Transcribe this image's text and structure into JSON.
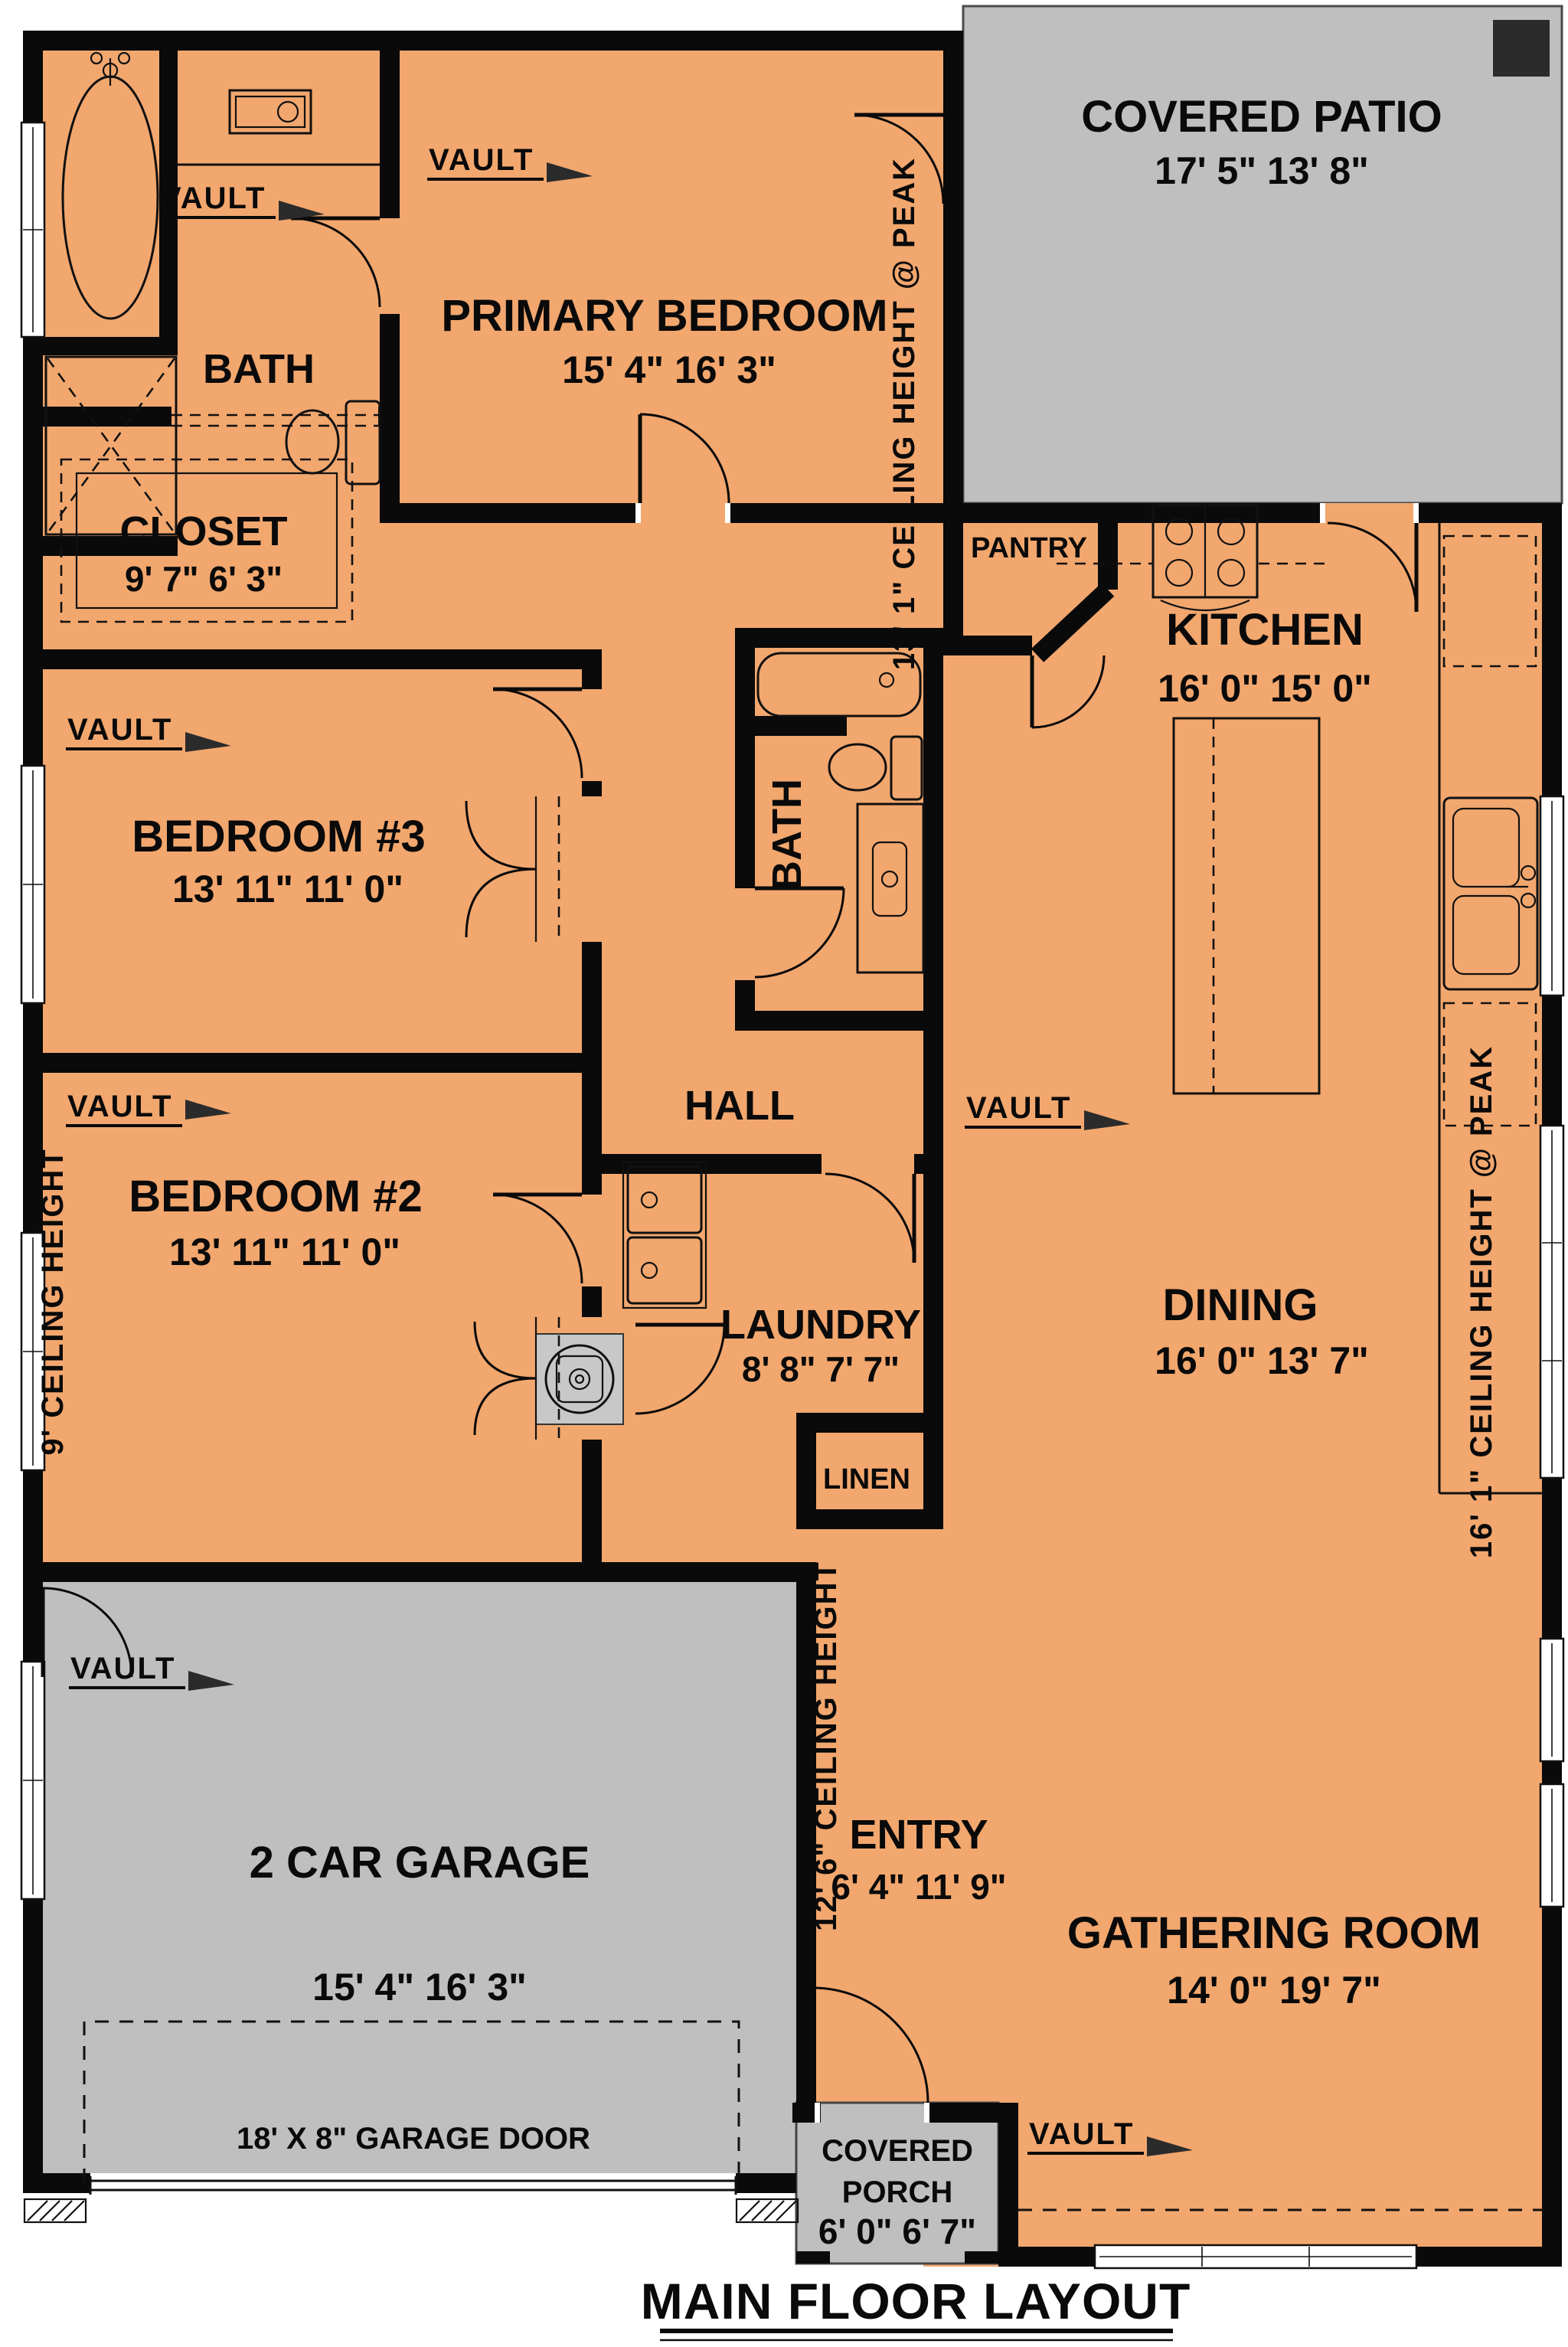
{
  "title": "MAIN FLOOR LAYOUT",
  "rooms": {
    "bath_primary": {
      "name": "BATH"
    },
    "primary_bedroom": {
      "name": "PRIMARY BEDROOM",
      "dims": "15' 4\" 16' 3\""
    },
    "covered_patio": {
      "name": "COVERED PATIO",
      "dims": "17' 5\" 13' 8\""
    },
    "closet": {
      "name": "CLOSET",
      "dims": "9' 7\" 6' 3\""
    },
    "pantry": {
      "name": "PANTRY"
    },
    "kitchen": {
      "name": "KITCHEN",
      "dims": "16' 0\" 15' 0\""
    },
    "bedroom_3": {
      "name": "BEDROOM #3",
      "dims": "13' 11\" 11' 0\""
    },
    "bath_2": {
      "name": "BATH"
    },
    "hall": {
      "name": "HALL"
    },
    "bedroom_2": {
      "name": "BEDROOM #2",
      "dims": "13' 11\" 11' 0\""
    },
    "dining": {
      "name": "DINING",
      "dims": "16' 0\" 13' 7\""
    },
    "laundry": {
      "name": "LAUNDRY",
      "dims": "8' 8\" 7' 7\""
    },
    "linen": {
      "name": "LINEN"
    },
    "garage": {
      "name": "2 CAR GARAGE",
      "dims": "15' 4\" 16' 3\""
    },
    "entry": {
      "name": "ENTRY",
      "dims": "6' 4\" 11' 9\""
    },
    "gathering_room": {
      "name": "GATHERING ROOM",
      "dims": "14' 0\" 19' 7\""
    },
    "covered_porch": {
      "name_line1": "COVERED",
      "name_line2": "PORCH",
      "dims": "6' 0\" 6' 7\""
    }
  },
  "annotations": {
    "vault": "VAULT",
    "garage_door": "18' X 8\" GARAGE DOOR",
    "ceiling_height_13": "13' 1\" CEILING HEIGHT @ PEAK",
    "ceiling_height_9": "9' CEILING HEIGHT",
    "ceiling_height_16": "16' 1\" CEILING HEIGHT @ PEAK",
    "ceiling_height_12": "12' 6\" CEILING HEIGHT"
  },
  "colors": {
    "floor": "#F2A76E",
    "outdoor": "#BFBFBF",
    "wall": "#0A0A0A",
    "patio_post": "#2B2B2B"
  }
}
